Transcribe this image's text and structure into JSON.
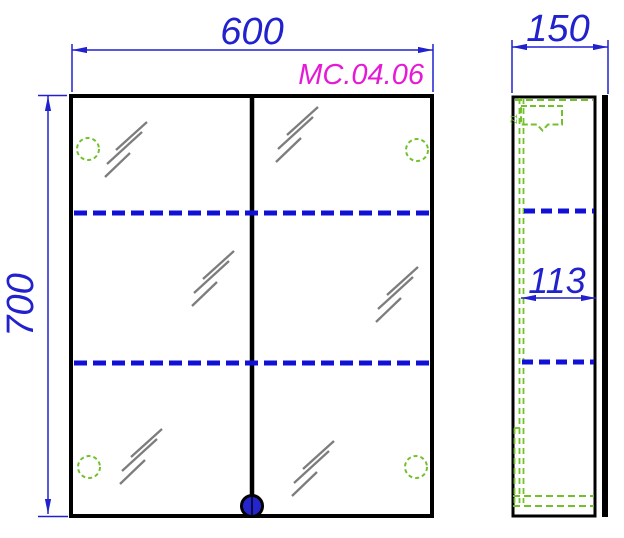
{
  "drawing": {
    "model_label": "MC.04.06",
    "front_view": {
      "width_mm": "600",
      "height_mm": "700",
      "shelf_lines": 2,
      "hinges": 4,
      "doors": 2
    },
    "side_view": {
      "depth_mm": "150",
      "inner_depth_mm": "113",
      "bracket_mm": "21",
      "shelf_lines": 2
    },
    "colors": {
      "dimension_blue": "#2121cd",
      "shelf_dash_blue": "#1111d6",
      "model_magenta": "#e61ad6",
      "hidden_line_green": "#72c02c",
      "mirror_hatch_gray": "#7d7d7d",
      "outline_black": "#000000",
      "knob_blue": "#2525cd",
      "background": "#ffffff"
    }
  }
}
